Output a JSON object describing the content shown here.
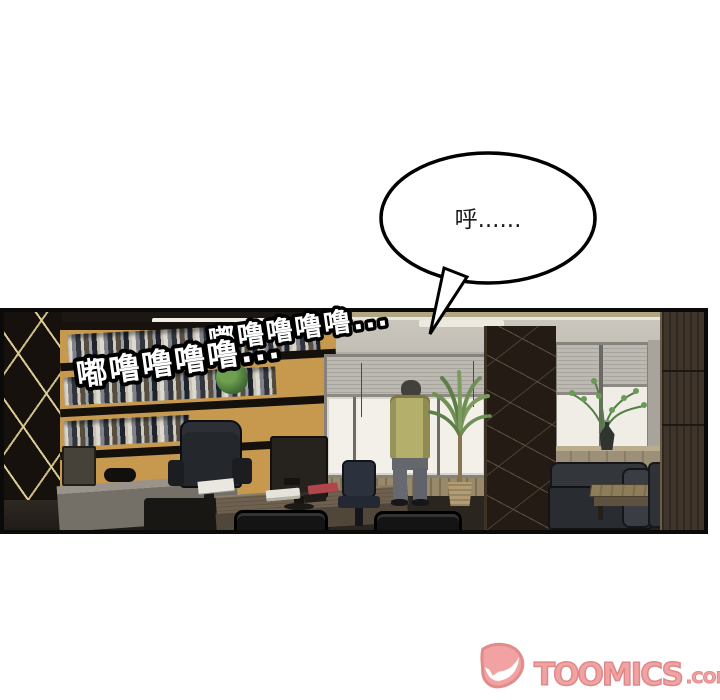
{
  "speech_bubble": {
    "text": "呼......"
  },
  "sfx": {
    "line1": "嘟噜噜噜噜...",
    "line2": "嘟噜噜噜噜..."
  },
  "watermark": {
    "brand": "TOOMICS",
    "domain": ".COM",
    "icon": "toomics-d-icon",
    "color": "#F0A3A3",
    "outline_color": "#E08888"
  }
}
